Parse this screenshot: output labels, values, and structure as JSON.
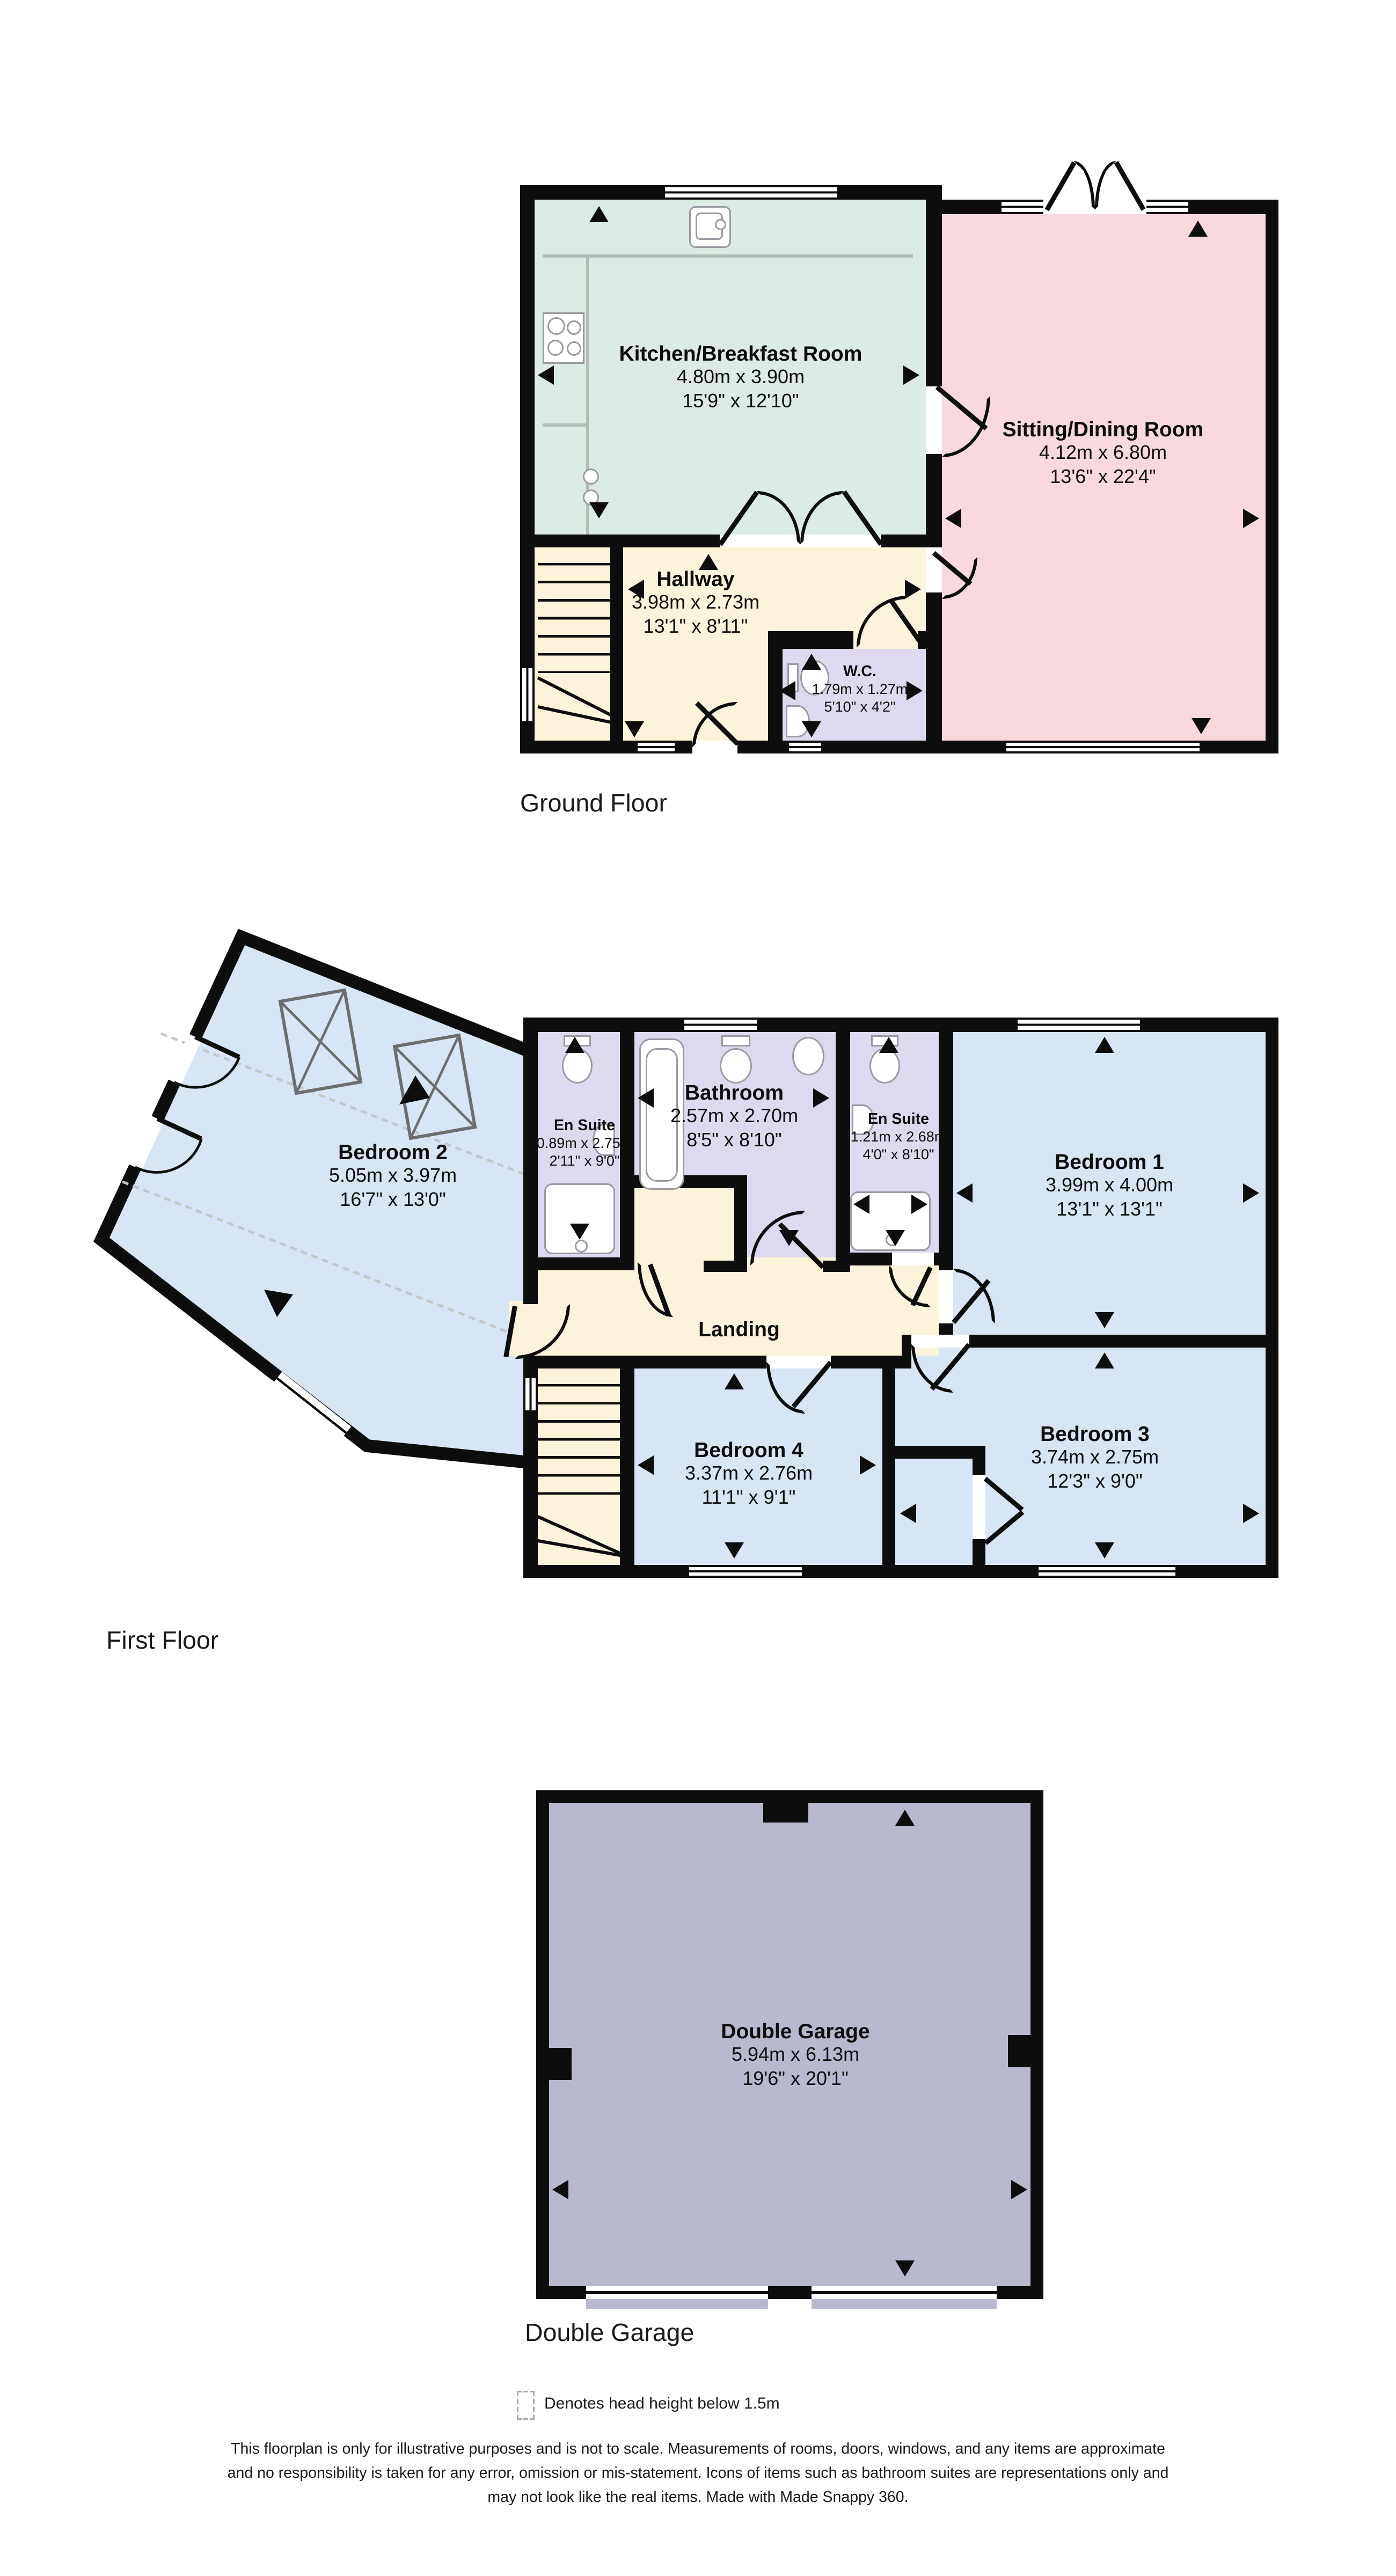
{
  "floors": {
    "ground": {
      "caption": "Ground Floor",
      "rooms": {
        "kitchen": {
          "name": "Kitchen/Breakfast Room",
          "metric": "4.80m x 3.90m",
          "imperial": "15'9\" x 12'10\""
        },
        "sitting": {
          "name": "Sitting/Dining Room",
          "metric": "4.12m x 6.80m",
          "imperial": "13'6\" x 22'4\""
        },
        "hallway": {
          "name": "Hallway",
          "metric": "3.98m x 2.73m",
          "imperial": "13'1\" x 8'11\""
        },
        "wc": {
          "name": "W.C.",
          "metric": "1.79m x 1.27m",
          "imperial": "5'10\" x 4'2\""
        }
      }
    },
    "first": {
      "caption": "First Floor",
      "rooms": {
        "bedroom2": {
          "name": "Bedroom 2",
          "metric": "5.05m x 3.97m",
          "imperial": "16'7\" x 13'0\""
        },
        "ensuite1": {
          "name": "En Suite",
          "metric": "0.89m x 2.75m",
          "imperial": "2'11\" x 9'0\""
        },
        "bathroom": {
          "name": "Bathroom",
          "metric": "2.57m x 2.70m",
          "imperial": "8'5\" x 8'10\""
        },
        "ensuite2": {
          "name": "En Suite",
          "metric": "1.21m x 2.68m",
          "imperial": "4'0\" x 8'10\""
        },
        "bedroom1": {
          "name": "Bedroom 1",
          "metric": "3.99m x 4.00m",
          "imperial": "13'1\" x 13'1\""
        },
        "landing": {
          "name": "Landing"
        },
        "bedroom4": {
          "name": "Bedroom 4",
          "metric": "3.37m x 2.76m",
          "imperial": "11'1\" x 9'1\""
        },
        "bedroom3": {
          "name": "Bedroom 3",
          "metric": "3.74m x 2.75m",
          "imperial": "12'3\" x 9'0\""
        }
      }
    },
    "garage": {
      "caption": "Double Garage",
      "rooms": {
        "garage": {
          "name": "Double Garage",
          "metric": "5.94m x 6.13m",
          "imperial": "19'6\" x 20'1\""
        }
      }
    }
  },
  "legend": {
    "text": "Denotes head height below 1.5m"
  },
  "disclaimer": {
    "line1": "This floorplan is only for illustrative purposes and is not to scale. Measurements of rooms, doors, windows, and any items are approximate",
    "line2": "and no responsibility is taken for any error, omission or mis-statement. Icons of items such as bathroom suites are representations only and",
    "line3": "may not look like the real items. Made with Made Snappy 360."
  },
  "colors": {
    "wall": "#0d0d0d",
    "kitchen": "#dcebe3",
    "sitting": "#f9d9de",
    "hallway": "#fcf4da",
    "wc_bath": "#ded9ee",
    "bedroom": "#d7e5f4",
    "garage": "#b9b9ce"
  }
}
